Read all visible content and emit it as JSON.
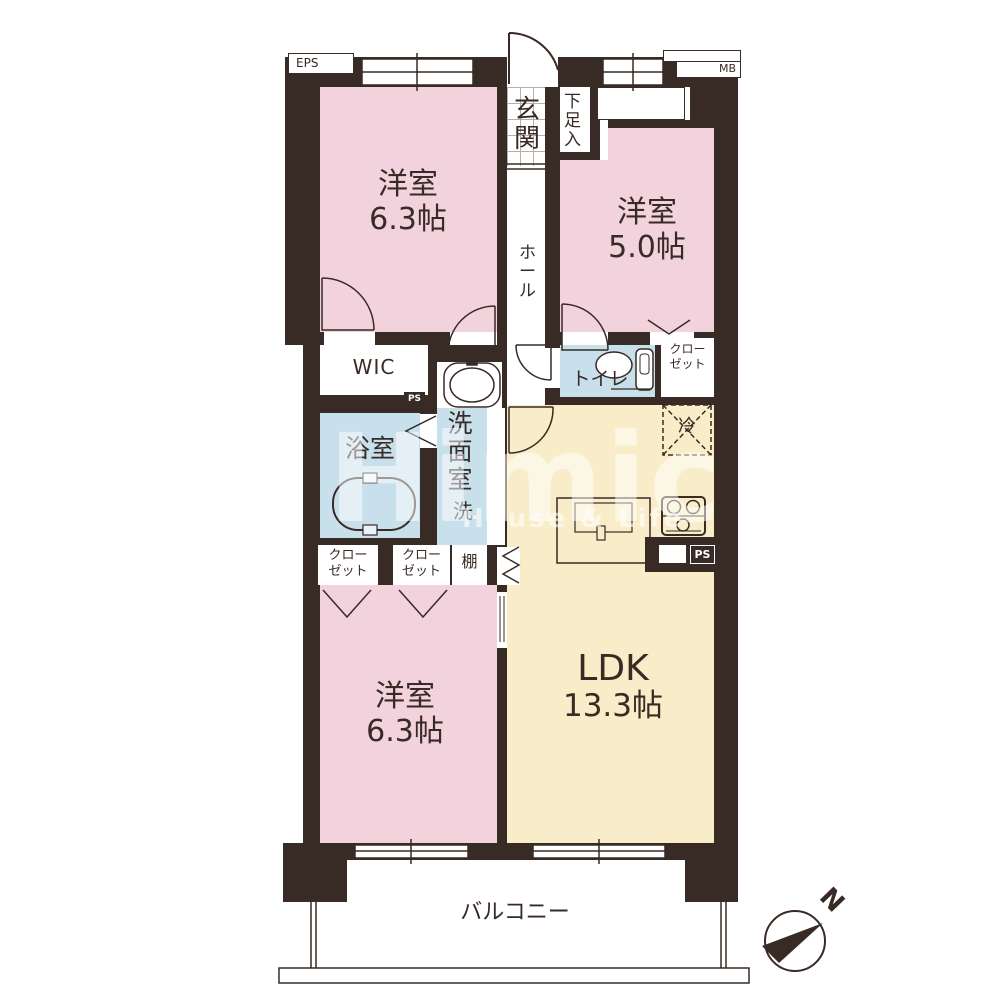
{
  "watermark": {
    "brand": "Himic",
    "tagline": "House & Life"
  },
  "compass": {
    "north_label": "N"
  },
  "rooms": {
    "bedroom_a": {
      "name": "洋室",
      "size": "6.3帖"
    },
    "bedroom_b": {
      "name": "洋室",
      "size": "5.0帖"
    },
    "bedroom_c": {
      "name": "洋室",
      "size": "6.3帖"
    },
    "ldk": {
      "name": "LDK",
      "size": "13.3帖"
    }
  },
  "areas": {
    "entrance": "玄関",
    "shoe_cabinet": "下足入",
    "hallway": "ホール",
    "walk_in_closet": "WIC",
    "bathroom": "浴室",
    "washroom": "洗面室",
    "washer": "洗",
    "toilet": "トイレ",
    "shelf": "棚",
    "refrigerator": "冷",
    "balcony": "バルコニー",
    "closet_line1": "クロー",
    "closet_line2": "ゼット"
  },
  "service_labels": {
    "eps": "EPS",
    "mb": "MB",
    "ps_upper": "PS",
    "ps_kitchen": "PS"
  },
  "colors": {
    "wall": "#382a24",
    "bedroom_pink": "#f1d2dd",
    "ldk_cream": "#f9ecc8",
    "wet_area_blue": "#c8e0ec",
    "watermark": "#ffffff"
  }
}
